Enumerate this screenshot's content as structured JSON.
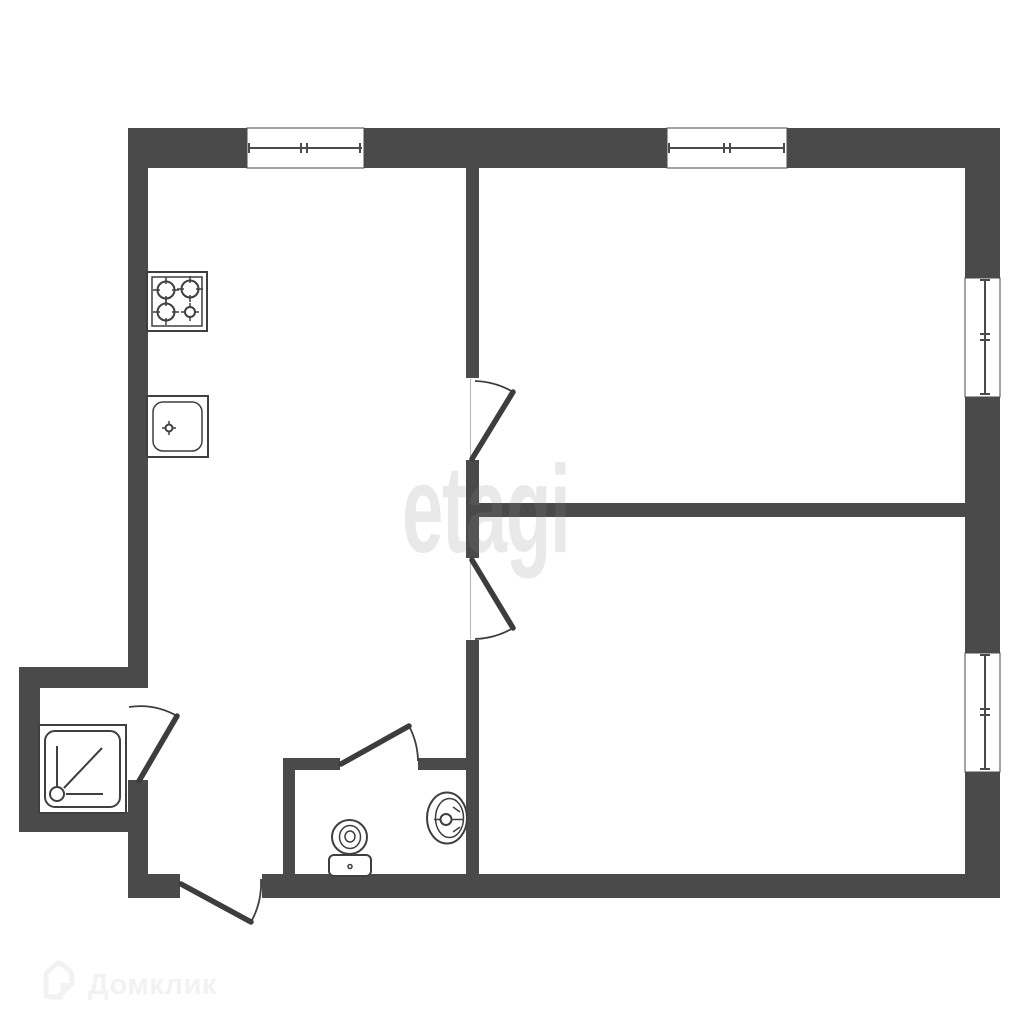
{
  "colors": {
    "background": "#ffffff",
    "wall": "#4a4a4a",
    "fixture": "#3f3f3f",
    "door": "#3d3d3d",
    "opening_line": "#b5b5b5",
    "watermark": "#8a8a8a",
    "logo": "#f2f2f2"
  },
  "watermarks": {
    "etagi": "etagi",
    "domclick": "Домклик"
  },
  "plan": {
    "type": "apartment-floor-plan",
    "fixture_icons": [
      "stove-icon",
      "kitchen-sink-icon",
      "shower-tray-icon",
      "toilet-icon",
      "washbasin-icon"
    ],
    "window_count": 4,
    "door_count": 5
  }
}
